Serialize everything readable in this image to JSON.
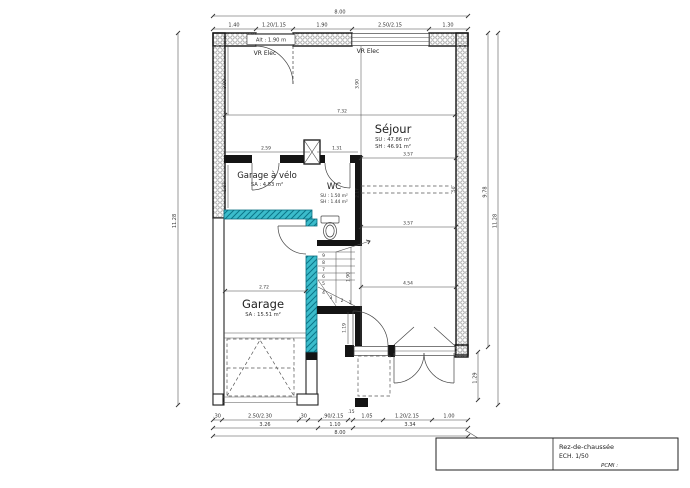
{
  "title_block": {
    "name": "Rez-de-chaussée",
    "scale": "ECH.  1/50",
    "pcmi": "PCMI :"
  },
  "rooms": {
    "sejour": {
      "name": "Séjour",
      "su": "SU : 47.86 m²",
      "sh": "SH : 46.91 m²"
    },
    "garage_velo": {
      "name": "Garage à vélo",
      "sa": "SA : 4.53 m²"
    },
    "wc": {
      "name": "WC",
      "su": "SU : 1.50 m²",
      "sh": "SH : 1.44 m²"
    },
    "garage": {
      "name": "Garage",
      "sa": "SA : 15.51 m²"
    }
  },
  "annotations": {
    "vr_elec_left": "VR Elec",
    "vr_elec_right": "VR Elec",
    "window_alt": "Alt : 1.90 m"
  },
  "dimensions": {
    "top_total": "8.00",
    "top_segments": [
      "1.40",
      "1.20/1.15",
      "1.90",
      "2.50/2.15",
      "1.30"
    ],
    "bottom_row1": [
      ".30",
      "2.50/2.30",
      ".30",
      ".90/2.15",
      ".15",
      "1.05",
      "1.20/2.15",
      "1.00"
    ],
    "bottom_row2": [
      "3.26",
      "1.10",
      "3.34"
    ],
    "bottom_total": "8.00",
    "left_total": "11.28",
    "right_height": "9.78",
    "right_total": "11.28",
    "right_lower": "1.29",
    "interior": {
      "hall_width": "7.32",
      "hall_height_left": "3.90",
      "hall_height_right": "3.90",
      "velo_width": "2.59",
      "velo_height": "1.87",
      "stair_top_width": "1.31",
      "sejour_width_upper": "3.57",
      "sejour_width_lower": "3.57",
      "wc_side_height": "2.17",
      "beam_offset": ".50",
      "garage_width": "2.72",
      "sejour_bottom_width": "4.54",
      "stair_height": "1.90",
      "door_side_height": "1.19"
    }
  },
  "stairs": {
    "steps": [
      "1",
      "2",
      "3",
      "4",
      "5",
      "6",
      "7",
      "8",
      "9"
    ]
  },
  "colors": {
    "highlight_wall": "#3bbccb",
    "wall": "#141414",
    "line": "#444444"
  }
}
